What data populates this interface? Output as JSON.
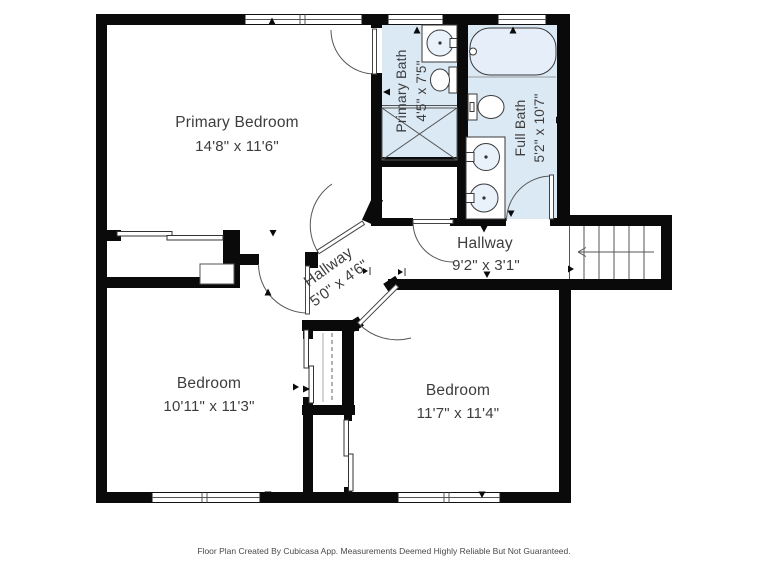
{
  "page": {
    "background": "#ffffff"
  },
  "colors": {
    "wall": "#0a0a0a",
    "bathroom_floor": "#dbe9f5",
    "label_text": "#3d3d3d",
    "fixture_line": "#3a3a3a"
  },
  "rooms": {
    "primary_bedroom": {
      "name": "Primary Bedroom",
      "dimensions": "14'8\" x 11'6\""
    },
    "primary_bath": {
      "name": "Primary Bath",
      "dimensions": "4'5\" x 7'5\""
    },
    "full_bath": {
      "name": "Full Bath",
      "dimensions": "5'2\" x 10'7\""
    },
    "hallway_upper": {
      "name": "Hallway",
      "dimensions": "9'2\" x 3'1\""
    },
    "hallway_lower": {
      "name": "Hallway",
      "dimensions": "5'0\" x 4'6\""
    },
    "bedroom_left": {
      "name": "Bedroom",
      "dimensions": "10'11\" x 11'3\""
    },
    "bedroom_right": {
      "name": "Bedroom",
      "dimensions": "11'7\" x 11'4\""
    }
  },
  "fixtures": [
    "bathtub",
    "toilet",
    "sink",
    "shower",
    "vanity",
    "closet-rod",
    "stairs"
  ],
  "footer": {
    "text": "Floor Plan Created By Cubicasa App. Measurements Deemed Highly Reliable But Not Guaranteed."
  }
}
